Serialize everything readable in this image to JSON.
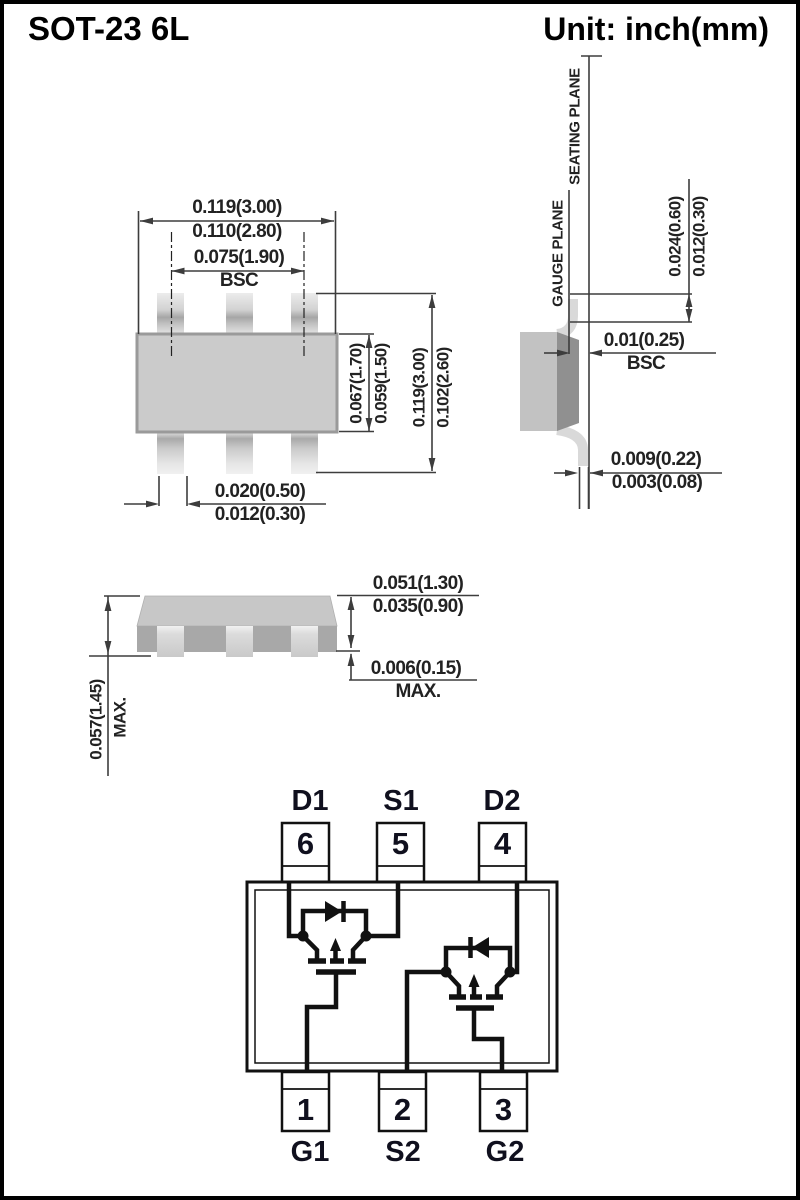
{
  "header": {
    "title": "SOT-23 6L",
    "unit": "Unit: inch(mm)"
  },
  "top_view": {
    "overall_width_max": "0.119(3.00)",
    "overall_width_min": "0.110(2.80)",
    "lead_pitch": "0.075(1.90)",
    "lead_pitch_note": "BSC",
    "body_depth_max": "0.067(1.70)",
    "body_depth_min": "0.059(1.50)",
    "overall_depth_max": "0.119(3.00)",
    "overall_depth_min": "0.102(2.60)",
    "lead_width_max": "0.020(0.50)",
    "lead_width_min": "0.012(0.30)"
  },
  "side_view": {
    "seating_plane": "SEATING PLANE",
    "gauge_plane": "GAUGE PLANE",
    "foot_length_max": "0.024(0.60)",
    "foot_length_min": "0.012(0.30)",
    "gauge_offset": "0.01(0.25)",
    "gauge_offset_note": "BSC",
    "lead_thickness_max": "0.009(0.22)",
    "lead_thickness_min": "0.003(0.08)"
  },
  "front_view": {
    "total_height": "0.057(1.45)",
    "total_height_note": "MAX.",
    "body_height_max": "0.051(1.30)",
    "body_height_min": "0.035(0.90)",
    "standoff": "0.006(0.15)",
    "standoff_note": "MAX."
  },
  "pinout": {
    "top_pins": [
      {
        "num": "6",
        "name": "D1"
      },
      {
        "num": "5",
        "name": "S1"
      },
      {
        "num": "4",
        "name": "D2"
      }
    ],
    "bottom_pins": [
      {
        "num": "1",
        "name": "G1"
      },
      {
        "num": "2",
        "name": "S2"
      },
      {
        "num": "3",
        "name": "G2"
      }
    ]
  },
  "colors": {
    "line": "#3d3d3d",
    "body_gray": "#cbcbcb",
    "schematic": "#111111"
  }
}
